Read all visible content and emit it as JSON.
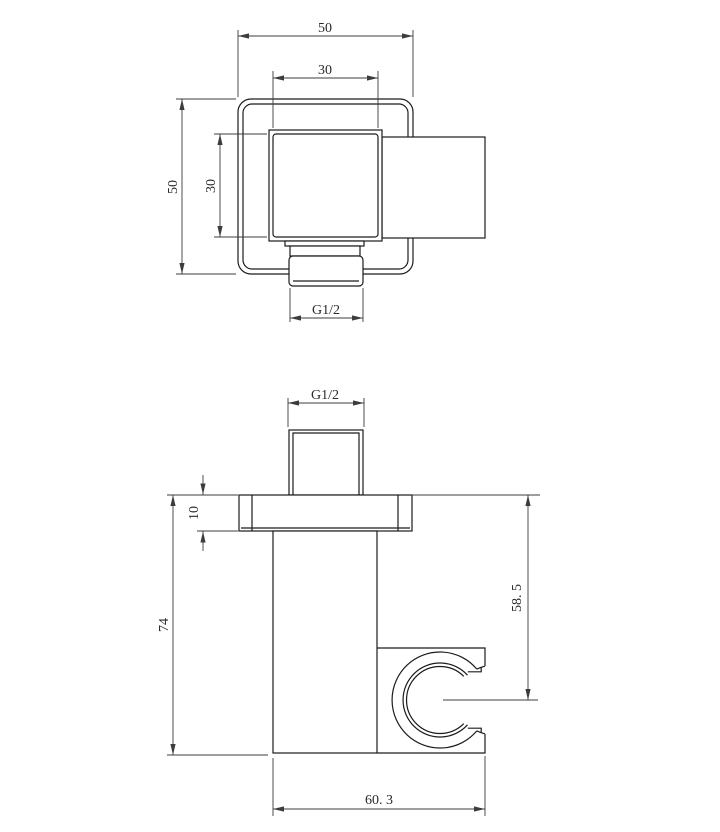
{
  "top_view": {
    "dim_overall_width": "50",
    "dim_inner_width": "30",
    "dim_overall_height": "50",
    "dim_inner_height": "30",
    "dim_thread": "G1/2"
  },
  "front_view": {
    "dim_thread": "G1/2",
    "dim_plate_thickness": "10",
    "dim_overall_height": "74",
    "dim_holder_center_height": "58. 5",
    "dim_overall_depth": "60. 3"
  },
  "colors": {
    "background": "#ffffff",
    "object_line": "#1c1c1c",
    "dimension_line": "#3c3c3c",
    "text": "#2a2a2a"
  }
}
